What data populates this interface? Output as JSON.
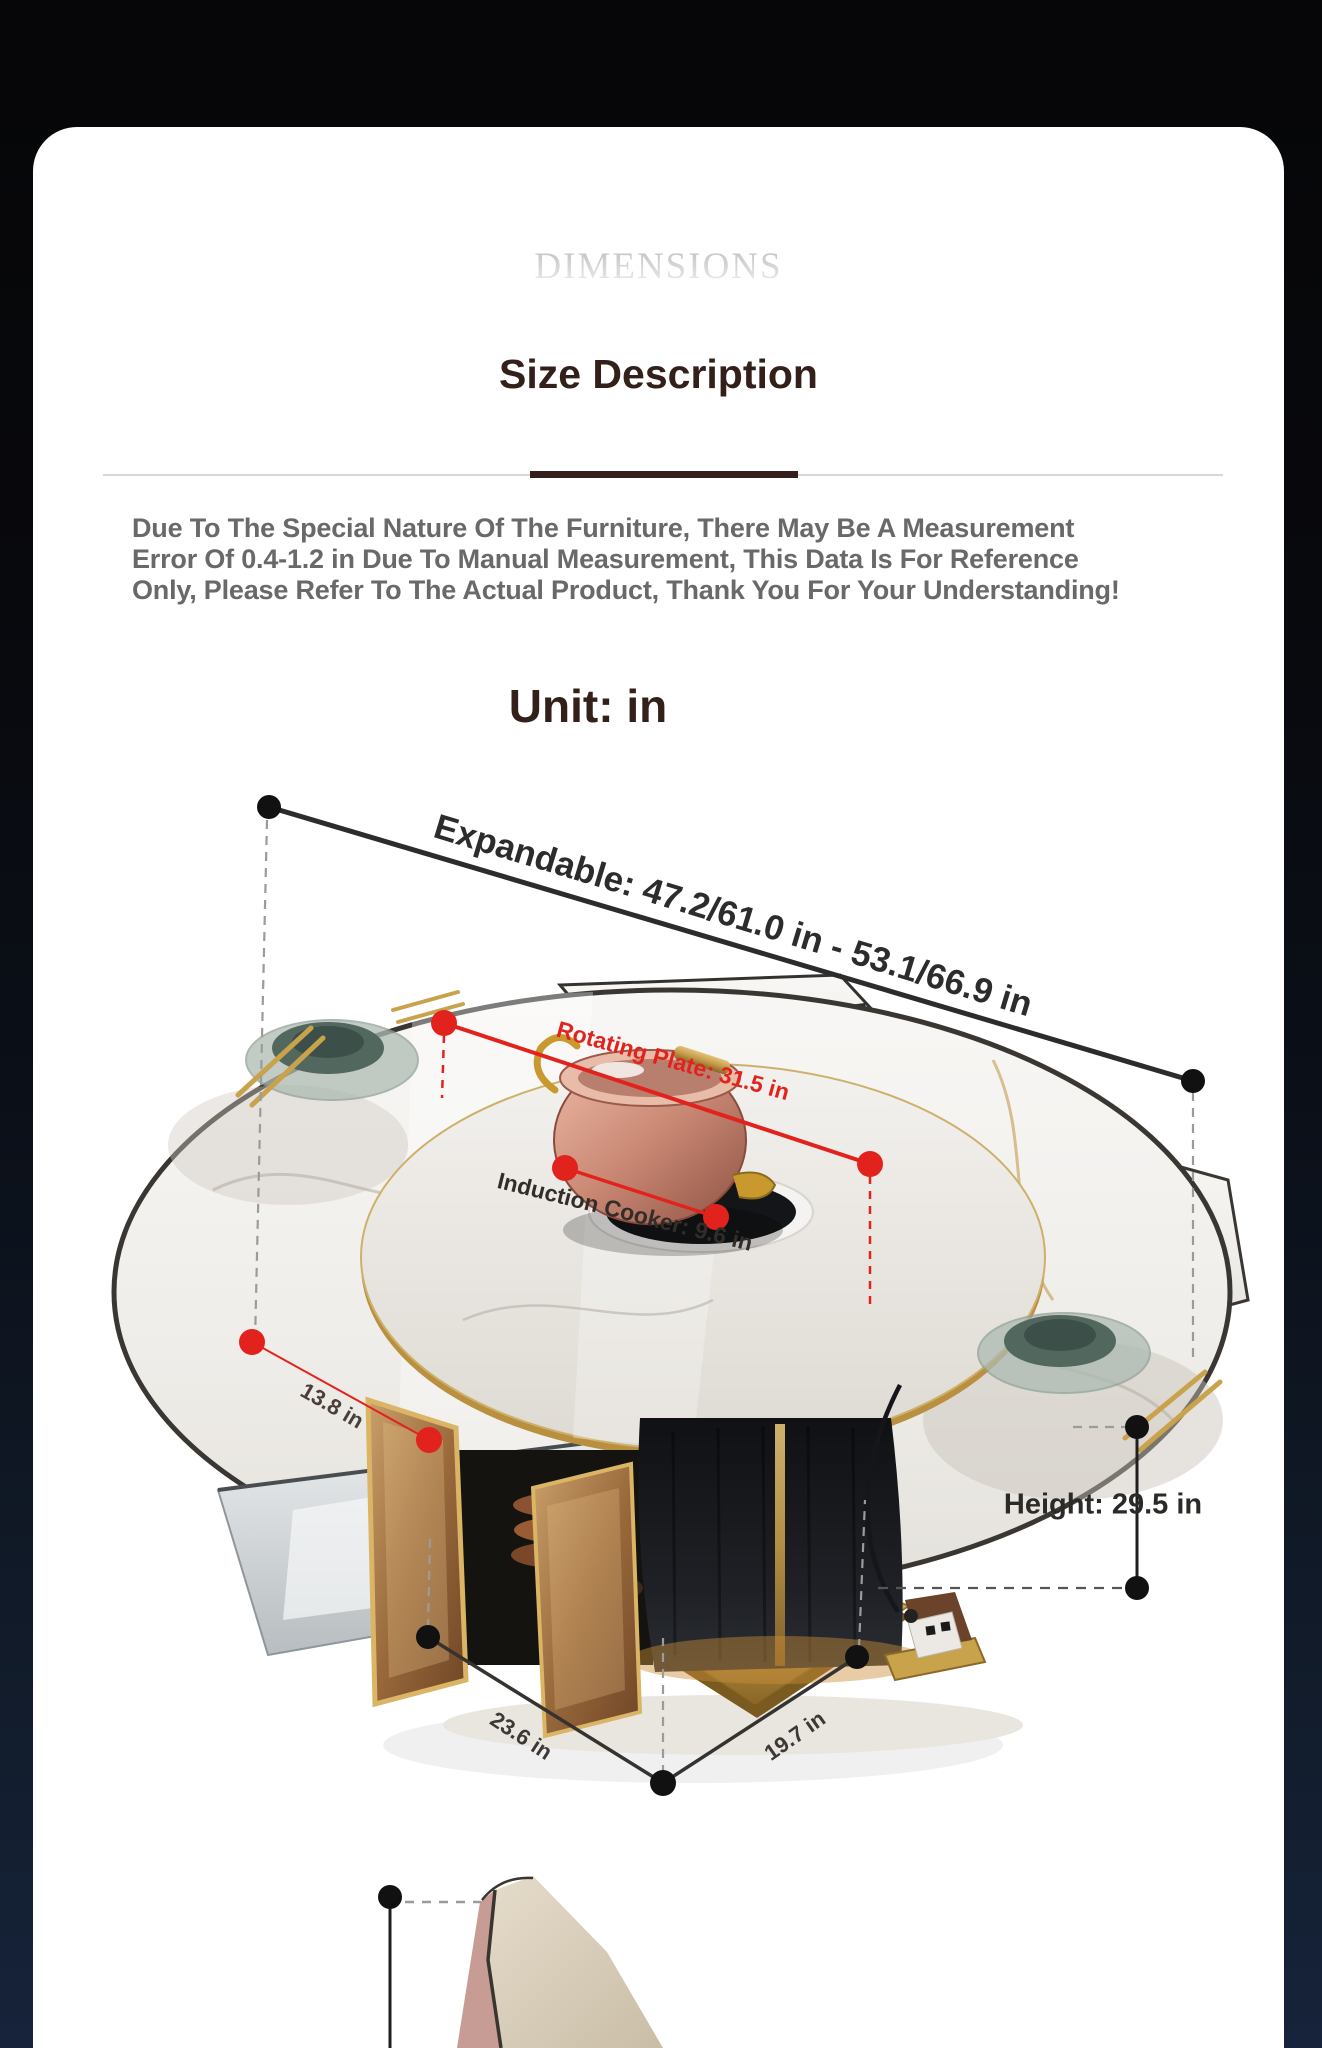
{
  "header": {
    "watermark": "DIMENSIONS",
    "title": "Size Description"
  },
  "notice": {
    "lines": [
      "Due To The Special Nature Of The Furniture, There May Be A Measurement",
      "Error Of 0.4-1.2 in Due To Manual Measurement, This Data Is For Reference",
      "Only, Please Refer To The Actual Product, Thank You For Your Understanding!"
    ]
  },
  "unit_heading": "Unit: in",
  "figure": {
    "labels": {
      "expandable": "Expandable: 47.2/61.0 in - 53.1/66.9 in",
      "rotating_plate": "Rotating Plate: 31.5 in",
      "induction_cooker": "Induction Cooker: 9.6 in",
      "extension": "13.8 in",
      "height": "Height: 29.5 in",
      "width": "23.6 in",
      "depth": "19.7 in"
    }
  },
  "colors": {
    "accent_red": "#e2231d",
    "title_brown": "#33201a",
    "notice_gray": "#696969",
    "gold": "#c9a24c",
    "card_bg": "#ffffff"
  }
}
